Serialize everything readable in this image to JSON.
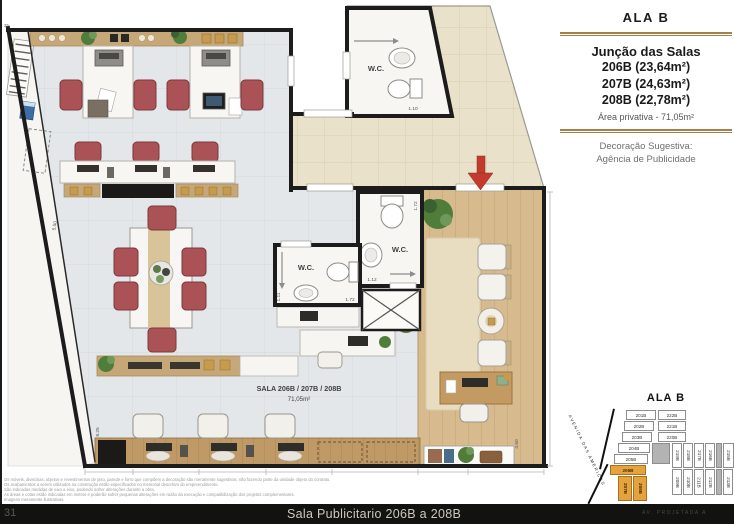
{
  "colors": {
    "accent_gold": "#a5814a",
    "highlight_orange": "#e6a23c",
    "wall_black": "#1c1c1c",
    "chair_red": "#ab5257",
    "wood_floor": "#d7bb8f",
    "footer_bg": "#121210",
    "entry_arrow_red": "#c23b2e"
  },
  "sidebar": {
    "title": "ALA B",
    "heading": "Junção das Salas",
    "units": [
      "206B (23,64m²)",
      "207B (24,63m²)",
      "208B (22,78m²)"
    ],
    "area": "Área privativa - 71,05m²",
    "decor_line1": "Decoração Sugestiva:",
    "decor_line2": "Agência de Publicidade"
  },
  "plan": {
    "wc_label": "W.C.",
    "room_label": "SALA 206B / 207B / 208B",
    "room_area": "71,05m²",
    "dims": {
      "wc_top": "1.10",
      "wc_left_w": "1.72",
      "wc_left_h": "1.11",
      "wc_right_w": "1.12",
      "wc_right_h": "1.72",
      "deck_h": "4.50",
      "office_h": "5.50",
      "counter": "8.25",
      "corner": "25"
    }
  },
  "keyplan": {
    "title": "ALA B",
    "street_left": "AVENIDA DAS AMERICAS",
    "street_bottom": "AV. PROJETADA A",
    "highlighted": [
      "206B",
      "207B",
      "208B"
    ],
    "left_column": [
      "201B",
      "202B",
      "203B",
      "204B",
      "205B",
      "206B"
    ],
    "left_rotated": [
      "207B",
      "208B"
    ],
    "right_column": [
      "222B",
      "221B",
      "220B"
    ],
    "row_top": [
      "219B",
      "218B",
      "217B",
      "216B",
      "215B"
    ],
    "row_bottom": [
      "209B",
      "210B",
      "211B",
      "212B",
      "213B",
      "214B"
    ]
  },
  "fineprint": {
    "lines": [
      "Os móveis, divisórias, objetos e revestimentos de piso, parede e forro que compõem a decoração são meramente sugestivos, não fazendo parte da unidade objeto do contrato.",
      "Os acabamentos a serem utilizados na construção estão especificados no memorial descritivo do empreendimento.",
      "São indicadas medidas de eixo a eixo, podendo sofrer alterações durante a obra.",
      "As áreas e cotas estão indicadas em metros e poderão sofrer pequenas alterações em razão da execução e compatibilização dos projetos complementares.",
      "Imagens meramente ilustrativas."
    ]
  },
  "footer": {
    "page_number": "31",
    "title": "Sala Publicitario 206B a 208B"
  }
}
